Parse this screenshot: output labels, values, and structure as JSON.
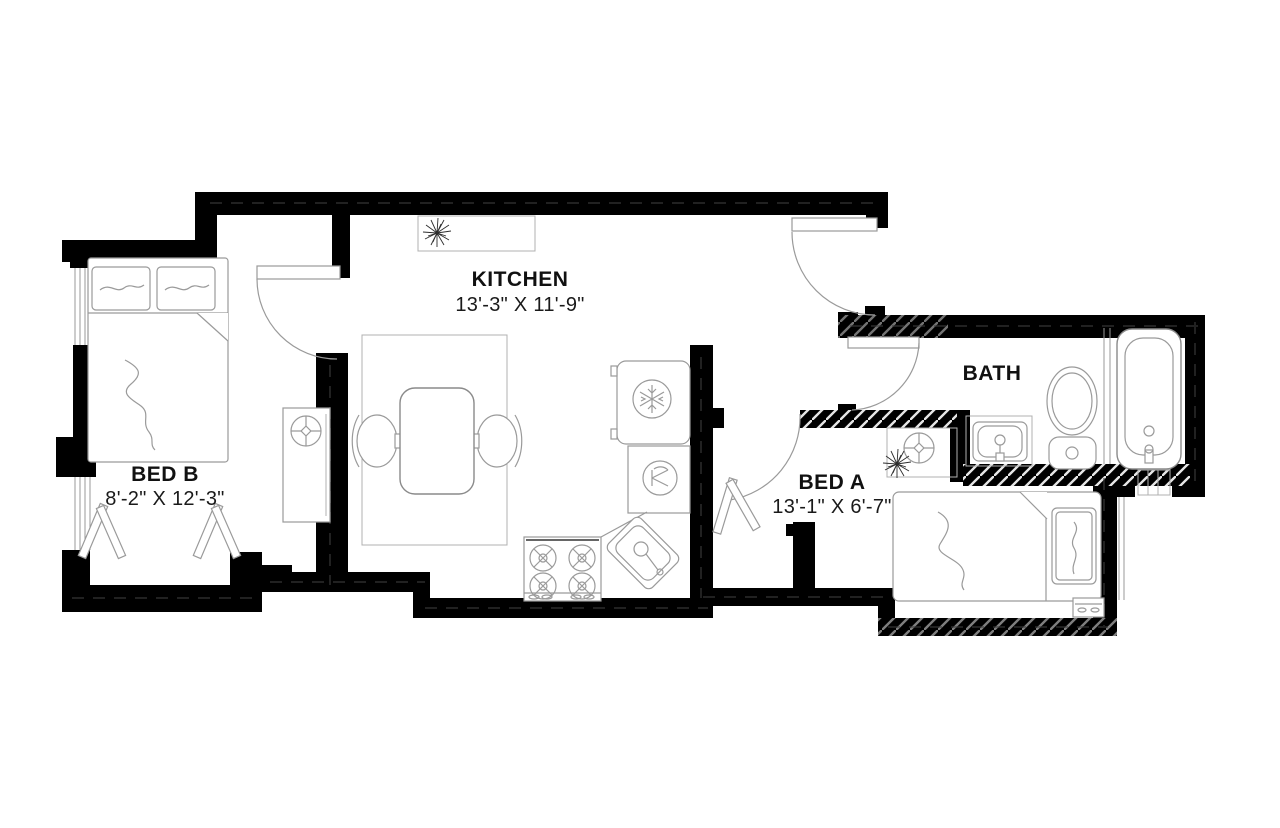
{
  "canvas": {
    "width": 1280,
    "height": 828,
    "background": "#ffffff"
  },
  "colors": {
    "wall": "#000000",
    "furniture_line": "#9a9a9a",
    "text": "#111111"
  },
  "rooms": {
    "kitchen": {
      "label": "KITCHEN",
      "dims": "13'-3\" X 11'-9\""
    },
    "bed_b": {
      "label": "BED B",
      "dims": "8'-2\" X 12'-3\""
    },
    "bed_a": {
      "label": "BED A",
      "dims": "13'-1\" X 6'-7\""
    },
    "bath": {
      "label": "BATH"
    }
  },
  "fixtures": [
    "double-bed",
    "pillows",
    "drying-rack",
    "washing-machine",
    "closet-washer",
    "area-rug",
    "dining-table",
    "chair",
    "refrigerator",
    "dishwasher",
    "stove",
    "kitchen-sink",
    "wall-shelf",
    "plant",
    "bathtub",
    "toilet",
    "vanity-sink",
    "single-bed",
    "nightstand",
    "door-swing",
    "window"
  ]
}
